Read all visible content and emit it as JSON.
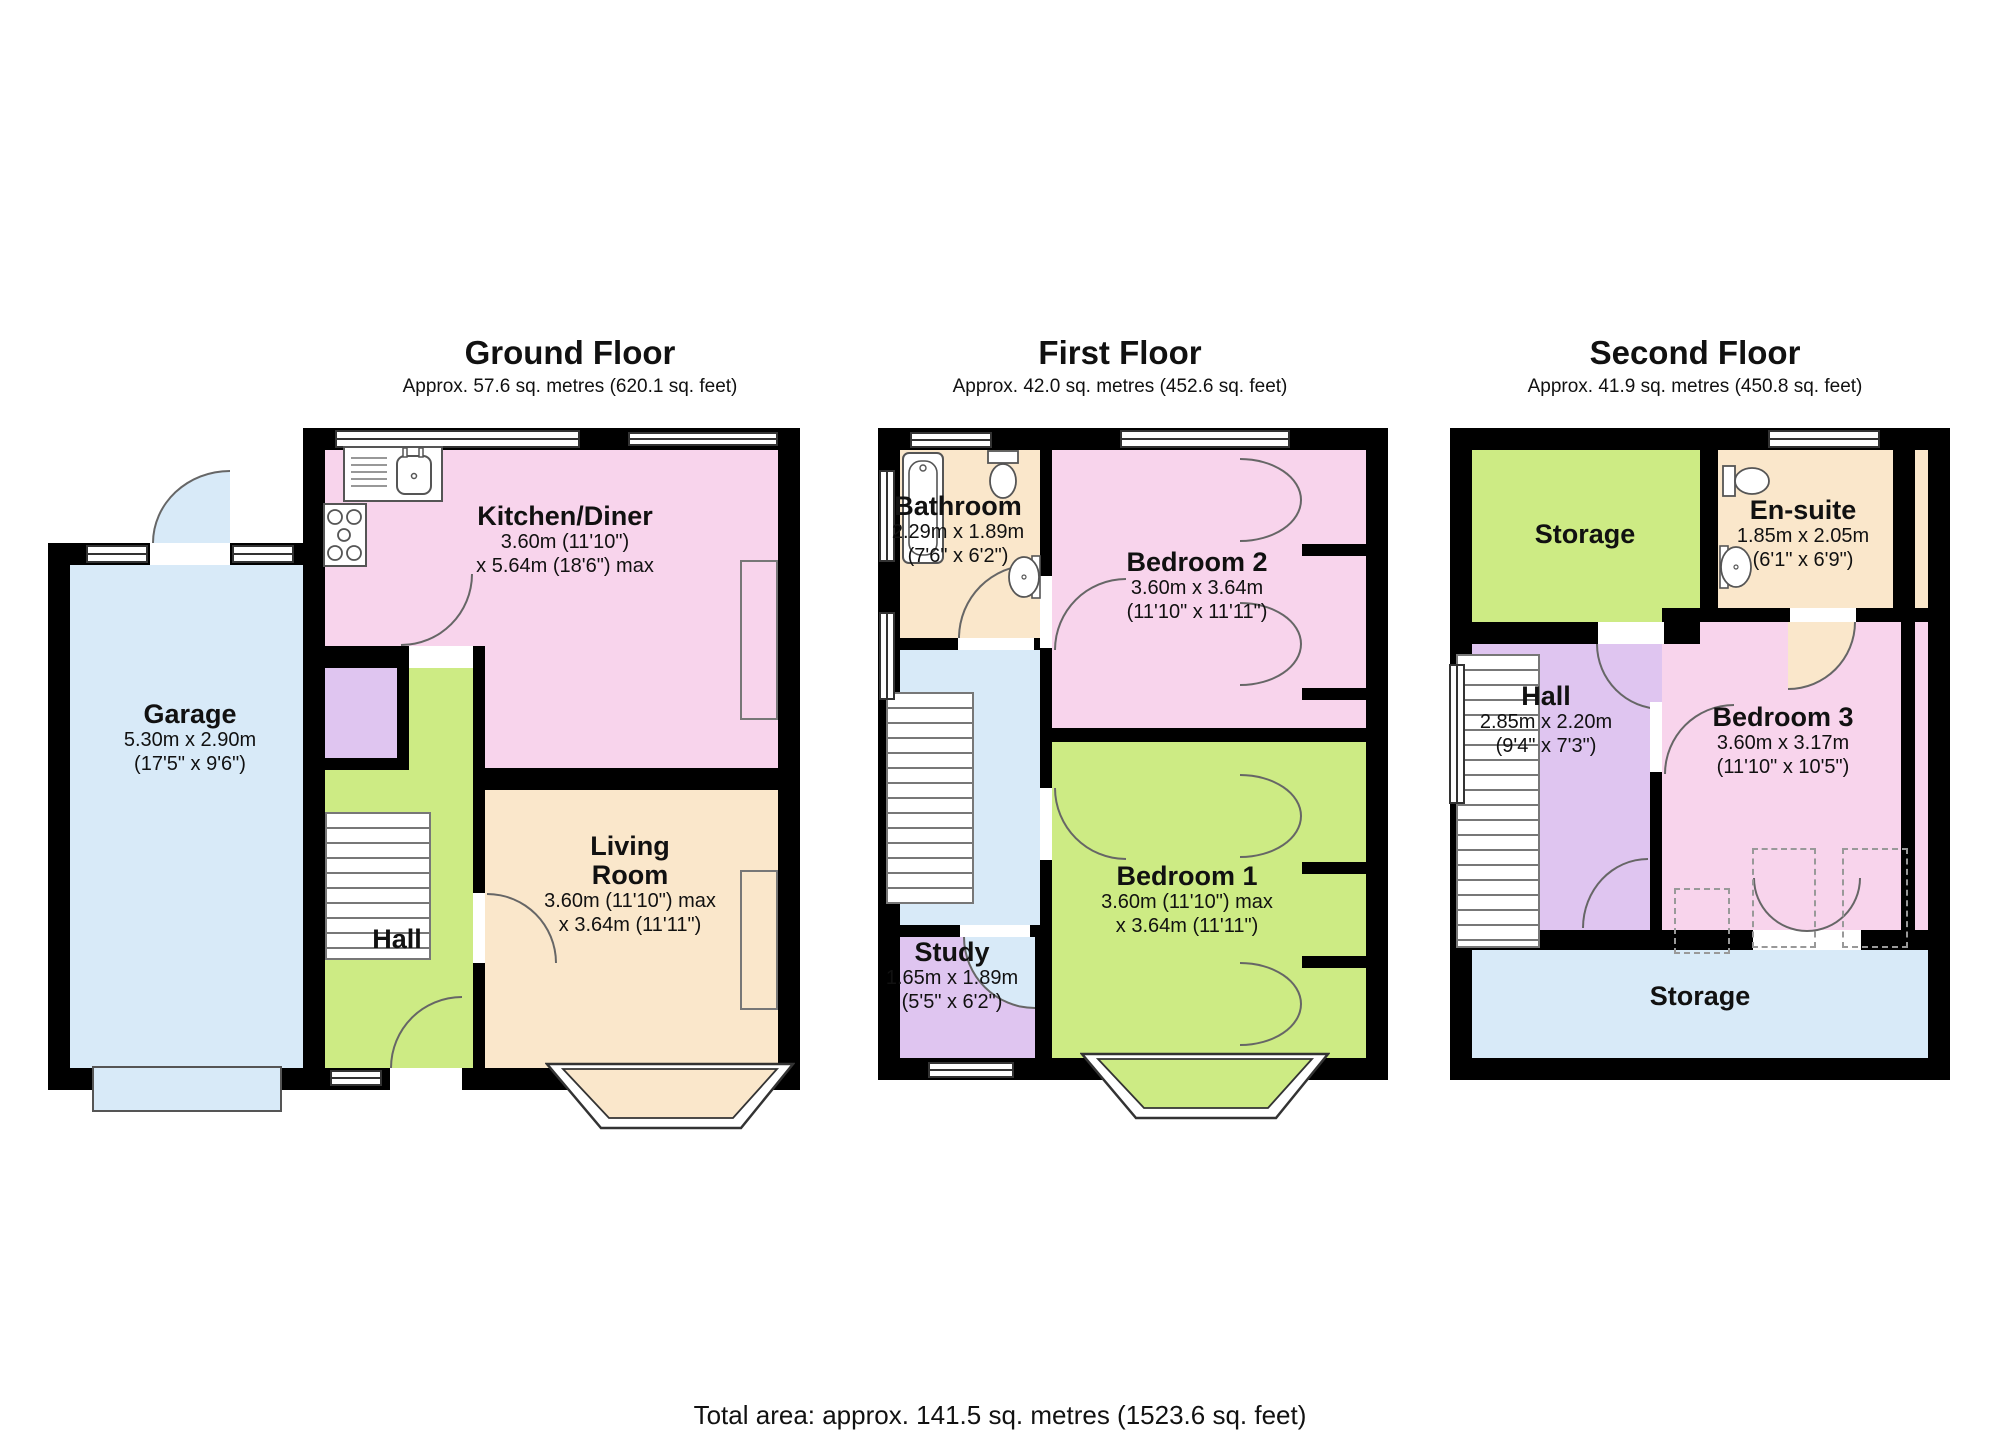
{
  "colors": {
    "pink": "#F8D4EC",
    "cream": "#FAE7CB",
    "green": "#CDEB84",
    "blue": "#D8EAF8",
    "purple": "#DFC5F0",
    "wall": "#000000"
  },
  "floors": [
    {
      "title": "Ground Floor",
      "subtitle": "Approx. 57.6 sq. metres (620.1 sq. feet)",
      "rooms": {
        "garage": {
          "name": "Garage",
          "dim_m": "5.30m x 2.90m",
          "dim_ft": "(17'5\" x 9'6\")"
        },
        "kitchen_diner": {
          "name": "Kitchen/Diner",
          "dim_m": "3.60m (11'10\")",
          "dim_ft": "x 5.64m (18'6\") max"
        },
        "living_room": {
          "name": "Living Room",
          "dim_m": "3.60m (11'10\") max",
          "dim_ft": "x 3.64m (11'11\")"
        },
        "hall": {
          "name": "Hall"
        }
      }
    },
    {
      "title": "First Floor",
      "subtitle": "Approx. 42.0 sq. metres (452.6 sq. feet)",
      "rooms": {
        "bathroom": {
          "name": "Bathroom",
          "dim_m": "2.29m x 1.89m",
          "dim_ft": "(7'6\" x 6'2\")"
        },
        "bedroom2": {
          "name": "Bedroom 2",
          "dim_m": "3.60m x 3.64m",
          "dim_ft": "(11'10\" x 11'11\")"
        },
        "bedroom1": {
          "name": "Bedroom 1",
          "dim_m": "3.60m (11'10\") max",
          "dim_ft": "x 3.64m (11'11\")"
        },
        "study": {
          "name": "Study",
          "dim_m": "1.65m x 1.89m",
          "dim_ft": "(5'5\" x 6'2\")"
        }
      }
    },
    {
      "title": "Second Floor",
      "subtitle": "Approx. 41.9 sq. metres (450.8 sq. feet)",
      "rooms": {
        "storage_top": {
          "name": "Storage"
        },
        "ensuite": {
          "name": "En-suite",
          "dim_m": "1.85m x 2.05m",
          "dim_ft": "(6'1\" x 6'9\")"
        },
        "hall": {
          "name": "Hall",
          "dim_m": "2.85m x 2.20m",
          "dim_ft": "(9'4\" x 7'3\")"
        },
        "bedroom3": {
          "name": "Bedroom 3",
          "dim_m": "3.60m x 3.17m",
          "dim_ft": "(11'10\" x 10'5\")"
        },
        "storage_bottom": {
          "name": "Storage"
        }
      }
    }
  ],
  "footer": {
    "total_area": "Total area: approx. 141.5 sq. metres (1523.6 sq. feet)"
  }
}
